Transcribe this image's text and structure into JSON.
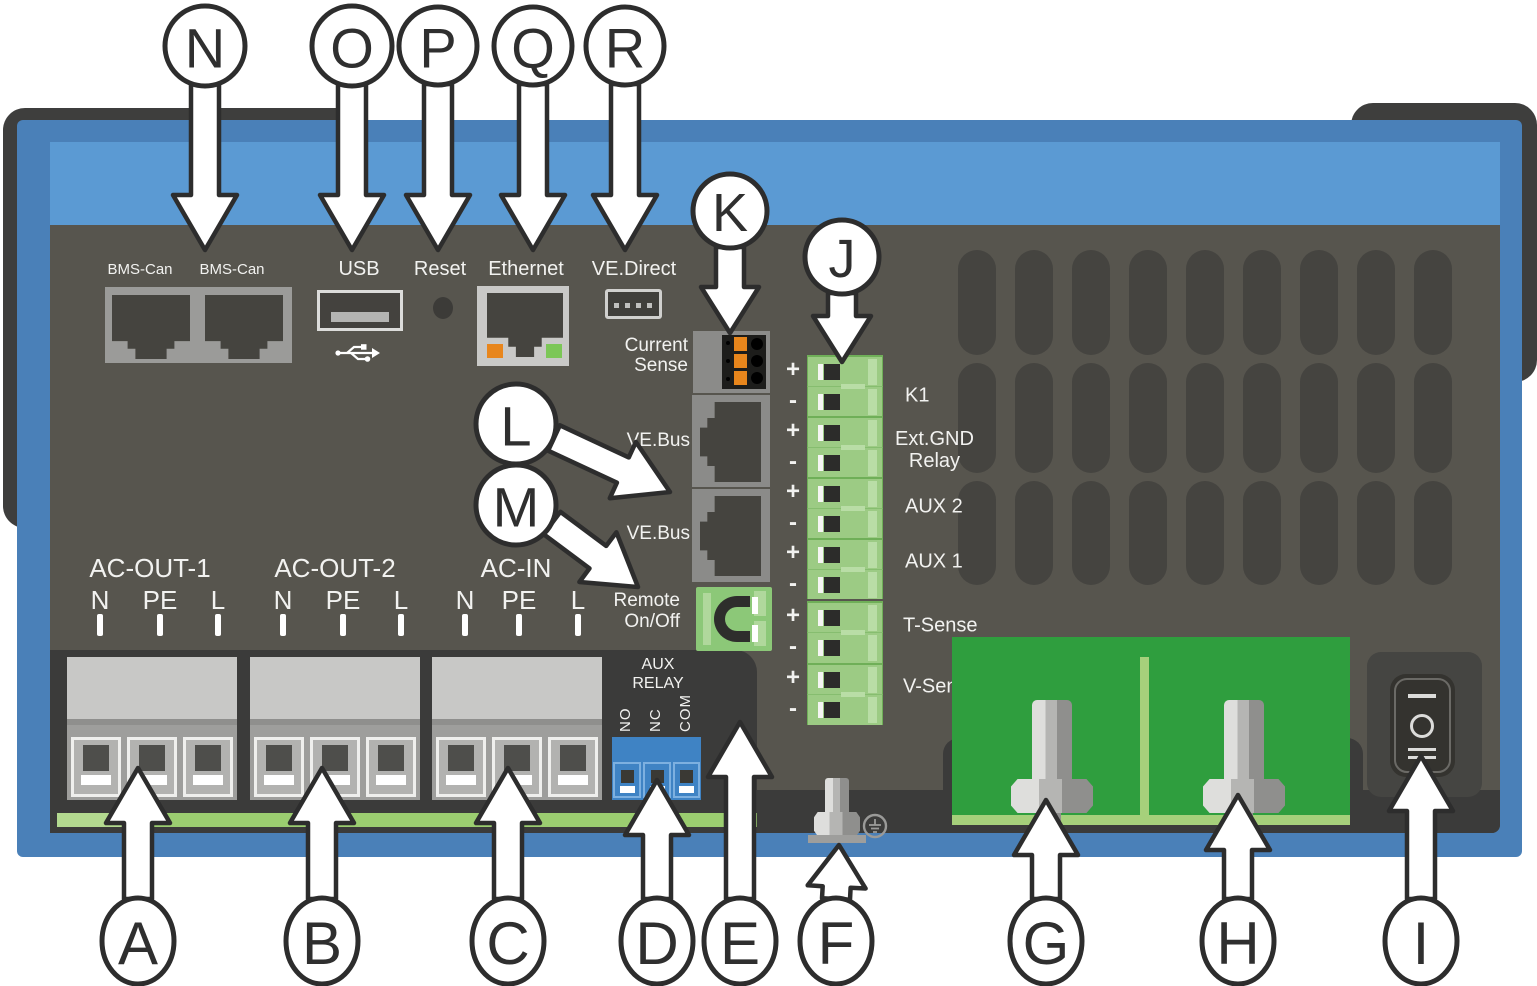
{
  "colors": {
    "frame": "#3e3e3d",
    "case-blue": "#4a80b8",
    "band-blue": "#5b9ad3",
    "panel": "#57554e",
    "recess": "#3b3b3a",
    "recess-light": "#454542",
    "vent": "#454440",
    "plate": "#9b9b99",
    "bezel": "#8b8b89",
    "bezel-light": "#c9c9c7",
    "port-dark": "#45443f",
    "label": "#f2f2f0",
    "green-connector": "#9ccb84",
    "green-connector-light": "#b9dda6",
    "green-connector-dark": "#6faf58",
    "cell-dark": "#2c2c2a",
    "pcb-green": "#2f9e3e",
    "pcb-light": "#a6d07b",
    "strip-green": "#9bcd70",
    "relay-blue": "#3f83c4",
    "relay-blue-light": "#7db0e0",
    "orange": "#e8861c",
    "led-green": "#7cc757",
    "metal-light": "#dededc",
    "metal-mid": "#b5b5b3",
    "metal-dark": "#8f8f8d",
    "terminal-cover": "#c8c8c6",
    "terminal-base": "#9e9e9c",
    "terminal-cell": "#b2b2b0",
    "terminal-square": "#4e4e4b",
    "switch-body": "#34332f",
    "callout-stroke": "#2d2d2d"
  },
  "top_ports": {
    "bms1": "BMS-Can",
    "bms2": "BMS-Can",
    "usb": "USB",
    "reset": "Reset",
    "ethernet": "Ethernet",
    "vedirect": "VE.Direct"
  },
  "mid_ports": {
    "current_sense": "Current\nSense",
    "vebus1": "VE.Bus",
    "vebus2": "VE.Bus",
    "remote": "Remote\nOn/Off"
  },
  "j_block": {
    "pairs": [
      {
        "plus": "+",
        "minus": "-",
        "label": "K1"
      },
      {
        "plus": "+",
        "minus": "-",
        "label": "Ext.GND\nRelay"
      },
      {
        "plus": "+",
        "minus": "-",
        "label": "AUX 2"
      },
      {
        "plus": "+",
        "minus": "-",
        "label": "AUX 1"
      },
      {
        "plus": "+",
        "minus": "-",
        "label": "T-Sense"
      },
      {
        "plus": "+",
        "minus": "-",
        "label": "V-Sense"
      }
    ]
  },
  "ac_groups": [
    {
      "name": "AC-OUT-1",
      "pins": [
        "N",
        "PE",
        "L"
      ]
    },
    {
      "name": "AC-OUT-2",
      "pins": [
        "N",
        "PE",
        "L"
      ]
    },
    {
      "name": "AC-IN",
      "pins": [
        "N",
        "PE",
        "L"
      ]
    }
  ],
  "aux_relay": {
    "line1": "AUX",
    "line2": "RELAY",
    "pins": [
      "NO",
      "NC",
      "COM"
    ]
  },
  "switch": {
    "markings": [
      "I",
      "O",
      "II"
    ]
  },
  "callouts": {
    "top": [
      "N",
      "O",
      "P",
      "Q",
      "R"
    ],
    "mid": [
      "K",
      "J",
      "L",
      "M"
    ],
    "bottom": [
      "A",
      "B",
      "C",
      "D",
      "E",
      "F",
      "G",
      "H",
      "I"
    ]
  }
}
